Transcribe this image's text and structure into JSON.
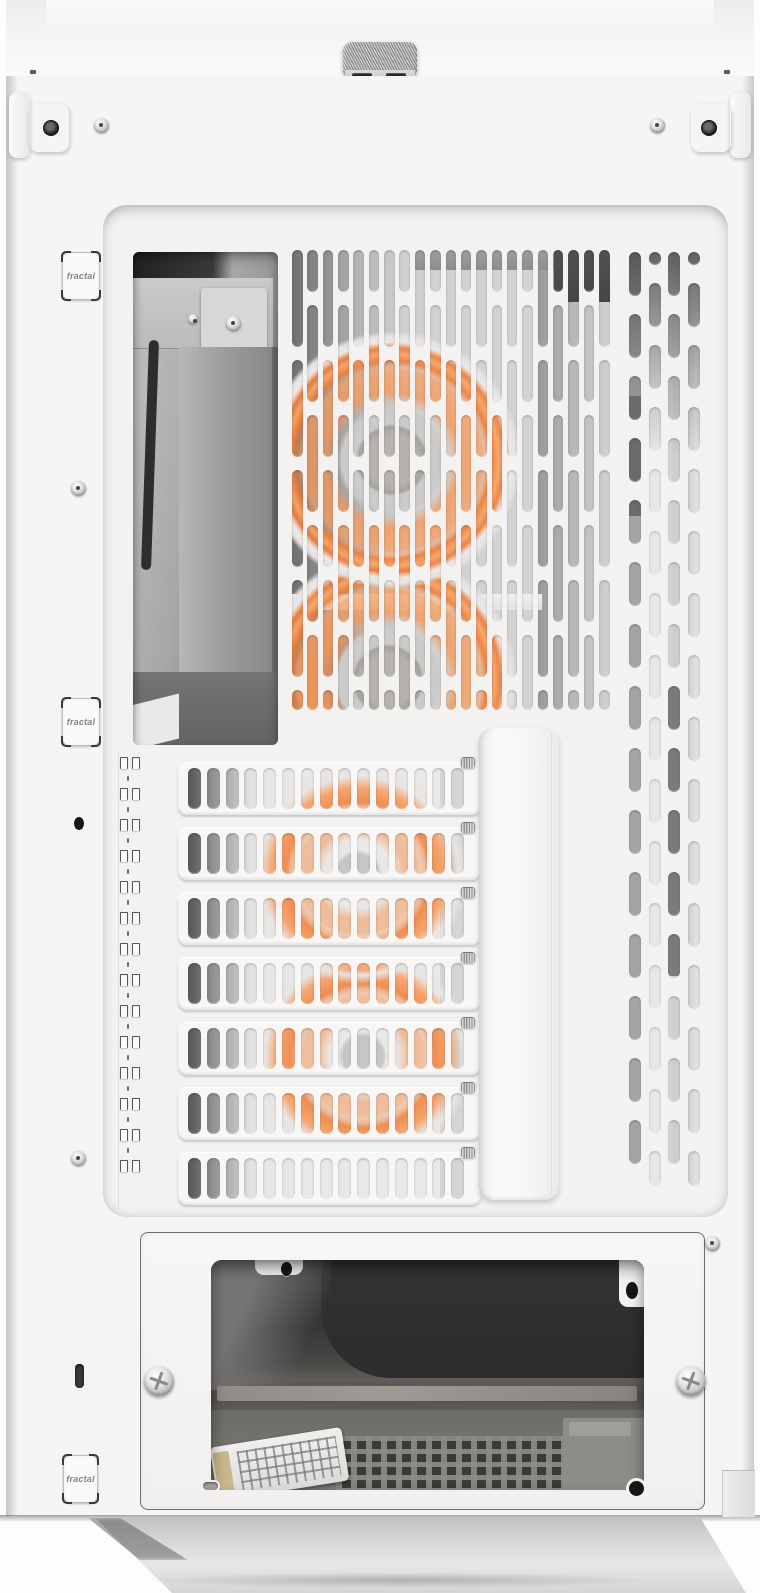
{
  "badges": {
    "hinge_top_label": "fractal",
    "hinge_middle_label": "fractal",
    "hinge_bottom_label": "fractal"
  },
  "colors": {
    "body_white": "#f6f5f4",
    "panel_inset": "#f3f2f1",
    "accent_orange": "#ef7d37",
    "accent_orange_light": "#f8a569",
    "interior_dark": "#3c3b3a",
    "interior_gray": "#8c8b89",
    "metal_silver": "#d9d8d6"
  },
  "structure": {
    "expansion_slot_covers": 7,
    "slot_cover_ovals": 15,
    "upper_vent_columns": 21,
    "right_vent_columns": 4,
    "right_vent_rows": 15,
    "clip_count": 14,
    "latch_slots": 2,
    "visible_rgb_fans": 2
  }
}
